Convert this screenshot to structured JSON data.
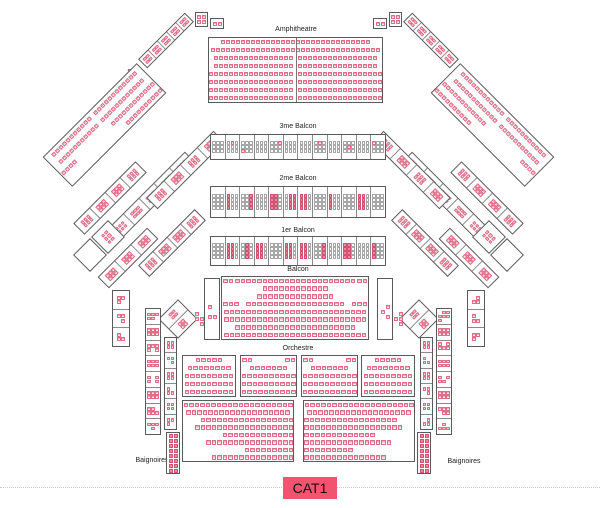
{
  "labels": {
    "amphitheatre": "Amphitheatre",
    "stalle_left": "Stalle",
    "stalle_right": "Stalle",
    "balcon_3me": "3me Balcon",
    "balcon_2me": "2me Balcon",
    "balcon_1er": "1er Balcon",
    "balcon": "Balcon",
    "orchestre": "Orchestre",
    "baignoires_left": "Baignoires",
    "baignoires_right": "Baignoires"
  },
  "legend": {
    "cat1_label": "CAT1",
    "badge_color": "#f2536f"
  },
  "seat_colors": {
    "pink_border": "#dd6b85",
    "pink_fill": "#fdeef1",
    "pink_top": "#f3aebd",
    "solid_fill": "#f287a0",
    "solid_border": "#d14f6e",
    "white_border": "#a5a5a5",
    "white_fill": "#ffffff"
  },
  "blocks": [
    {
      "name": "loge-top-left-a",
      "x": 195,
      "y": 12,
      "w": 13,
      "h": 15,
      "border": true,
      "grid": {
        "cols": 2,
        "pat": "pppp"
      },
      "seat": {
        "s": 4
      }
    },
    {
      "name": "loge-top-left-b",
      "x": 210,
      "y": 18,
      "w": 14,
      "h": 11,
      "border": true,
      "grid": {
        "cols": 2,
        "pat": "pp"
      },
      "seat": {
        "s": 4
      }
    },
    {
      "name": "loge-top-right-a",
      "x": 389,
      "y": 12,
      "w": 13,
      "h": 15,
      "border": true,
      "grid": {
        "cols": 2,
        "pat": "pppp"
      },
      "seat": {
        "s": 4
      }
    },
    {
      "name": "loge-top-right-b",
      "x": 373,
      "y": 18,
      "w": 14,
      "h": 11,
      "border": true,
      "grid": {
        "cols": 2,
        "pat": "pp"
      },
      "seat": {
        "s": 4
      }
    },
    {
      "name": "stalle-chain-left",
      "x": 133,
      "y": 34,
      "w": 66,
      "h": 13,
      "rot": -45,
      "border": true,
      "seat": {
        "s": 3.5
      },
      "cells": {
        "dir": "h",
        "cols": 2,
        "list": [
          "pppp",
          "pppp",
          "pppp",
          "pppp",
          "pppp"
        ]
      }
    },
    {
      "name": "stalle-chain-right",
      "x": 398,
      "y": 34,
      "w": 66,
      "h": 13,
      "rot": 45,
      "border": true,
      "seat": {
        "s": 3.5
      },
      "cells": {
        "dir": "h",
        "cols": 2,
        "list": [
          "pppp",
          "pppp",
          "pppp",
          "pppp",
          "pppp"
        ]
      }
    },
    {
      "name": "stalle-left-seats",
      "x": 38,
      "y": 104,
      "w": 133,
      "h": 42,
      "rot": -45,
      "border": true,
      "seat": {
        "s": 4
      },
      "rows": [
        {
          "halves": [
            11,
            12
          ]
        },
        {
          "halves": [
            11,
            12
          ]
        },
        {
          "groups": [
            4,
            12
          ]
        },
        {
          "n": 10,
          "align": "right"
        }
      ]
    },
    {
      "name": "stalle-right-seats",
      "x": 426,
      "y": 104,
      "w": 133,
      "h": 42,
      "rot": 45,
      "border": true,
      "seat": {
        "s": 4
      },
      "rows": [
        {
          "halves": [
            12,
            11
          ]
        },
        {
          "halves": [
            12,
            11
          ]
        },
        {
          "groups": [
            12,
            4
          ]
        },
        {
          "n": 10,
          "align": "left"
        }
      ]
    },
    {
      "name": "loges-diag-left-1",
      "x": 66,
      "y": 190,
      "w": 88,
      "h": 16,
      "rot": -45,
      "border": true,
      "seat": {
        "s": 3.5
      },
      "cells": {
        "dir": "h",
        "cols": 3,
        "list": [
          "pppppp",
          "pppppp",
          "pppppp",
          "pppppp"
        ]
      }
    },
    {
      "name": "loges-diag-left-2",
      "x": 97,
      "y": 188,
      "w": 110,
      "h": 17,
      "rot": -45,
      "border": true,
      "seat": {
        "s": 3.5
      },
      "cells": {
        "dir": "h",
        "cols": 3,
        "list": [
          "pppppp",
          "pppppp",
          "pppppp",
          "pppppp",
          "pppppp"
        ]
      }
    },
    {
      "name": "loges-diag-left-3",
      "x": 138,
      "y": 162,
      "w": 95,
      "h": 16,
      "rot": -45,
      "border": true,
      "seat": {
        "s": 3.5
      },
      "cells": {
        "dir": "h",
        "cols": 3,
        "list": [
          "pppppp",
          "pppppp",
          "pppppp",
          "pppppp"
        ]
      }
    },
    {
      "name": "loges-diag-left-4",
      "x": 132,
      "y": 235,
      "w": 80,
      "h": 16,
      "rot": -45,
      "border": true,
      "seat": {
        "s": 3.5
      },
      "cells": {
        "dir": "h",
        "cols": 3,
        "list": [
          "pppppp",
          "pppppp",
          "pppppp",
          "pppppp"
        ]
      }
    },
    {
      "name": "loges-diag-left-5",
      "x": 93,
      "y": 250,
      "w": 70,
      "h": 16,
      "rot": -45,
      "border": true,
      "seat": {
        "s": 3.5
      },
      "cells": {
        "dir": "h",
        "cols": 3,
        "list": [
          "pppppp",
          "pppppp",
          "pppppp"
        ]
      }
    },
    {
      "name": "loges-diag-right-1",
      "x": 443,
      "y": 190,
      "w": 88,
      "h": 16,
      "rot": 45,
      "border": true,
      "seat": {
        "s": 3.5
      },
      "cells": {
        "dir": "h",
        "cols": 3,
        "list": [
          "pppppp",
          "pppppp",
          "pppppp",
          "pppppp"
        ]
      }
    },
    {
      "name": "loges-diag-right-2",
      "x": 390,
      "y": 188,
      "w": 110,
      "h": 17,
      "rot": 45,
      "border": true,
      "seat": {
        "s": 3.5
      },
      "cells": {
        "dir": "h",
        "cols": 3,
        "list": [
          "pppppp",
          "pppppp",
          "pppppp",
          "pppppp",
          "pppppp"
        ]
      }
    },
    {
      "name": "loges-diag-right-3",
      "x": 364,
      "y": 162,
      "w": 95,
      "h": 16,
      "rot": 45,
      "border": true,
      "seat": {
        "s": 3.5
      },
      "cells": {
        "dir": "h",
        "cols": 3,
        "list": [
          "pppppp",
          "pppppp",
          "pppppp",
          "pppppp"
        ]
      }
    },
    {
      "name": "loges-diag-right-4",
      "x": 385,
      "y": 235,
      "w": 80,
      "h": 16,
      "rot": 45,
      "border": true,
      "seat": {
        "s": 3.5
      },
      "cells": {
        "dir": "h",
        "cols": 3,
        "list": [
          "pppppp",
          "pppppp",
          "pppppp",
          "pppppp"
        ]
      }
    },
    {
      "name": "loges-diag-right-5",
      "x": 434,
      "y": 250,
      "w": 70,
      "h": 16,
      "rot": 45,
      "border": true,
      "seat": {
        "s": 3.5
      },
      "cells": {
        "dir": "h",
        "cols": 3,
        "list": [
          "pppppp",
          "pppppp",
          "pppppp"
        ]
      }
    },
    {
      "name": "loge-diamond-left-seated",
      "x": 96,
      "y": 225,
      "w": 24,
      "h": 24,
      "rot": 45,
      "border": true,
      "grid": {
        "cols": 3,
        "pat": "pppppp"
      },
      "seat": {
        "s": 3.5
      }
    },
    {
      "name": "loge-diamond-left-empty",
      "x": 78,
      "y": 243,
      "w": 24,
      "h": 24,
      "rot": 45,
      "border": true,
      "grid": {
        "cols": 1,
        "pat": "e"
      },
      "seat": {
        "s": 3.5
      }
    },
    {
      "name": "loge-diamond-right-seated",
      "x": 477,
      "y": 225,
      "w": 24,
      "h": 24,
      "rot": 45,
      "border": true,
      "grid": {
        "cols": 3,
        "pat": "pppppp"
      },
      "seat": {
        "s": 3.5
      }
    },
    {
      "name": "loge-diamond-right-empty",
      "x": 495,
      "y": 243,
      "w": 24,
      "h": 24,
      "rot": 45,
      "border": true,
      "grid": {
        "cols": 1,
        "pat": "e"
      },
      "seat": {
        "s": 3.5
      }
    },
    {
      "name": "loge-pinwheel-left",
      "x": 164,
      "y": 305,
      "w": 28,
      "h": 28,
      "rot": 45,
      "border": true,
      "seat": {
        "s": 3.5
      },
      "cells": {
        "dir": "h",
        "cols": 2,
        "list": [
          "pppp",
          "pppp"
        ]
      }
    },
    {
      "name": "loge-pinwheel-right",
      "x": 405,
      "y": 305,
      "w": 28,
      "h": 28,
      "rot": 45,
      "border": true,
      "seat": {
        "s": 3.5
      },
      "cells": {
        "dir": "h",
        "cols": 2,
        "list": [
          "pppp",
          "pppp"
        ]
      }
    },
    {
      "name": "amphitheatre-seats",
      "x": 208,
      "y": 37,
      "w": 175,
      "h": 66,
      "border": true,
      "vline": true,
      "seat": {
        "s": 4
      },
      "rows": [
        {
          "n": 30
        },
        {
          "n": 34
        },
        {
          "halves": [
            16,
            16
          ]
        },
        {
          "halves": [
            16,
            16
          ]
        },
        {
          "halves": [
            17,
            17
          ]
        },
        {
          "halves": [
            17,
            17
          ]
        },
        {
          "halves": [
            17,
            17
          ]
        },
        {
          "halves": [
            17,
            17
          ]
        }
      ]
    },
    {
      "name": "balcon-3me-loges",
      "x": 210,
      "y": 134,
      "w": 176,
      "h": 26,
      "border": true,
      "seat": {
        "s": 3.5
      },
      "cells": {
        "dir": "h",
        "cols": 3,
        "list": [
          "wwwwwwwww",
          "wpwwwwwww",
          "wwwwwwpww",
          "wwwwwwwww",
          "wwpwwwwww",
          "wwwwwwwww",
          "wwwwwwwww",
          "wpwwwwwww",
          "wwwwwwwww",
          "wwwwpwwww",
          "wwwwwwwww",
          "pwwwwwwww"
        ]
      }
    },
    {
      "name": "balcon-2me-loges",
      "x": 210,
      "y": 186,
      "w": 176,
      "h": 32,
      "border": true,
      "seat": {
        "s": 3.5
      },
      "cells": {
        "dir": "h",
        "cols": 3,
        "list": [
          "wwwwwwwwwwww",
          "swwswwswwsww",
          "wwswwswwswws",
          "wwwwwwwwwwww",
          "sswsswsswssw",
          "wsswsswsswss",
          "sswsswsswssw",
          "wwwwwwwwwwww",
          "swwswwswwsww",
          "wwwwwwwwwwww",
          "sswsswsswssw",
          "wwwwwwwwwwww"
        ]
      }
    },
    {
      "name": "balcon-1er-loges",
      "x": 210,
      "y": 236,
      "w": 176,
      "h": 30,
      "border": true,
      "seat": {
        "s": 3.5
      },
      "cells": {
        "dir": "h",
        "cols": 3,
        "list": [
          "wwwwwwwwwwww",
          "sswsswsswssw",
          "wswwswwswwsw",
          "sswsswsswssw",
          "wwwwwwwwwwww",
          "sswsswsswssw",
          "sswsswsswssw",
          "wwswwswwswws",
          "wwwwwwwwwwww",
          "sswsswsswssw",
          "wwwwwwwwwwww",
          "swwswwswwsww"
        ]
      }
    },
    {
      "name": "balcon-left-box",
      "x": 204,
      "y": 278,
      "w": 16,
      "h": 62,
      "border": true,
      "grid": {
        "cols": 2,
        "pat": "eeeepeeeppee"
      },
      "seat": {
        "s": 4
      }
    },
    {
      "name": "balcon-seats",
      "x": 221,
      "y": 276,
      "w": 148,
      "h": 64,
      "border": true,
      "seat": {
        "s": 4.5
      },
      "rows": [
        {
          "groups": [
            2,
            22,
            2
          ]
        },
        {
          "n": 12
        },
        {
          "n": 14
        },
        {
          "groups": [
            3,
            18,
            3
          ]
        },
        {
          "n": 26
        },
        {
          "n": 26
        },
        {
          "n": 22
        },
        {
          "n": 26
        }
      ]
    },
    {
      "name": "balcon-right-box",
      "x": 377,
      "y": 278,
      "w": 16,
      "h": 62,
      "border": true,
      "grid": {
        "cols": 2,
        "pat": "eeeeeppeepee"
      },
      "seat": {
        "s": 4
      }
    },
    {
      "name": "balcon-outer-left",
      "x": 194,
      "y": 302,
      "w": 10,
      "h": 34,
      "grid": {
        "cols": 2,
        "pat": "peppep"
      },
      "seat": {
        "s": 4
      }
    },
    {
      "name": "balcon-outer-right",
      "x": 393,
      "y": 302,
      "w": 10,
      "h": 34,
      "grid": {
        "cols": 2,
        "pat": "epppep"
      },
      "seat": {
        "s": 4
      }
    },
    {
      "name": "orchestre-block-1",
      "x": 182,
      "y": 355,
      "w": 54,
      "h": 42,
      "border": true,
      "seat": {
        "s": 4.5
      },
      "rows": [
        {
          "n": 5
        },
        {
          "n": 8
        },
        {
          "n": 9
        },
        {
          "n": 9
        },
        {
          "n": 9
        }
      ]
    },
    {
      "name": "orchestre-block-2",
      "x": 240,
      "y": 355,
      "w": 57,
      "h": 42,
      "border": true,
      "seat": {
        "s": 4.5
      },
      "rows": [
        {
          "groups": [
            2,
            2
          ]
        },
        {
          "n": 7
        },
        {
          "n": 10
        },
        {
          "n": 10
        },
        {
          "n": 10
        }
      ]
    },
    {
      "name": "orchestre-block-3",
      "x": 301,
      "y": 355,
      "w": 57,
      "h": 42,
      "border": true,
      "seat": {
        "s": 4.5
      },
      "rows": [
        {
          "groups": [
            2,
            2
          ]
        },
        {
          "n": 7
        },
        {
          "n": 10
        },
        {
          "n": 10
        },
        {
          "n": 10
        }
      ]
    },
    {
      "name": "orchestre-block-4",
      "x": 361,
      "y": 355,
      "w": 54,
      "h": 42,
      "border": true,
      "seat": {
        "s": 4.5
      },
      "rows": [
        {
          "n": 5
        },
        {
          "n": 8
        },
        {
          "n": 9
        },
        {
          "n": 9
        },
        {
          "n": 9
        }
      ]
    },
    {
      "name": "orchestre-left-seats",
      "x": 182,
      "y": 400,
      "w": 112,
      "h": 62,
      "border": true,
      "seat": {
        "s": 4.5
      },
      "rows": [
        {
          "n": 20
        },
        {
          "n": 19
        },
        {
          "n": 17,
          "align": "right"
        },
        {
          "n": 18,
          "align": "right"
        },
        {
          "n": 13,
          "align": "right"
        },
        {
          "n": 16,
          "align": "right"
        },
        {
          "n": 9,
          "align": "right"
        },
        {
          "n": 15,
          "align": "right"
        }
      ]
    },
    {
      "name": "orchestre-right-seats",
      "x": 303,
      "y": 400,
      "w": 112,
      "h": 62,
      "border": true,
      "seat": {
        "s": 4.5
      },
      "rows": [
        {
          "n": 20
        },
        {
          "n": 19
        },
        {
          "n": 17,
          "align": "left"
        },
        {
          "n": 18,
          "align": "left"
        },
        {
          "n": 13,
          "align": "left"
        },
        {
          "n": 16,
          "align": "left"
        },
        {
          "n": 9,
          "align": "left"
        },
        {
          "n": 15,
          "align": "left"
        }
      ]
    },
    {
      "name": "loges-side-left-upper",
      "x": 112,
      "y": 290,
      "w": 18,
      "h": 57,
      "border": true,
      "seat": {
        "s": 4
      },
      "cells": {
        "dir": "v",
        "cols": 2,
        "list": [
          "pppe",
          "ppep",
          "pepp"
        ]
      }
    },
    {
      "name": "loges-side-left-mid",
      "x": 145,
      "y": 308,
      "w": 16,
      "h": 127,
      "border": true,
      "seat": {
        "s": 3.5
      },
      "cells": {
        "dir": "v",
        "cols": 3,
        "list": [
          "pppppe",
          "pppppp",
          "ppppep",
          "pppppp",
          "peppep",
          "pppppp",
          "ppeppp",
          "pppepe"
        ]
      }
    },
    {
      "name": "loges-side-left-inner",
      "x": 164,
      "y": 337,
      "w": 13,
      "h": 93,
      "border": true,
      "seat": {
        "s": 3.5
      },
      "cells": {
        "dir": "v",
        "cols": 2,
        "list": [
          "pppp",
          "ppep",
          "pppp",
          "pepp",
          "pppp",
          "pppe"
        ]
      }
    },
    {
      "name": "baignoires-left-seats",
      "x": 166,
      "y": 432,
      "w": 14,
      "h": 42,
      "border": true,
      "seat": {
        "s": 4
      },
      "grid": {
        "cols": 2,
        "pat": "ssssssssssssssss"
      }
    },
    {
      "name": "loges-side-right-upper",
      "x": 467,
      "y": 290,
      "w": 18,
      "h": 57,
      "border": true,
      "seat": {
        "s": 4
      },
      "cells": {
        "dir": "v",
        "cols": 2,
        "list": [
          "eppp",
          "pepp",
          "pppe"
        ]
      }
    },
    {
      "name": "loges-side-right-mid",
      "x": 436,
      "y": 308,
      "w": 16,
      "h": 127,
      "border": true,
      "seat": {
        "s": 3.5
      },
      "cells": {
        "dir": "v",
        "cols": 3,
        "list": [
          "epppppp",
          "pppppp",
          "peppppe",
          "pppppp",
          "pepppe",
          "pppppp",
          "pppepp",
          "epeppp"
        ]
      }
    },
    {
      "name": "loges-side-right-inner",
      "x": 420,
      "y": 337,
      "w": 13,
      "h": 93,
      "border": true,
      "seat": {
        "s": 3.5
      },
      "cells": {
        "dir": "v",
        "cols": 2,
        "list": [
          "pppp",
          "pepp",
          "pppp",
          "ppep",
          "pppp",
          "eppp"
        ]
      }
    },
    {
      "name": "baignoires-right-seats",
      "x": 417,
      "y": 432,
      "w": 14,
      "h": 42,
      "border": true,
      "seat": {
        "s": 4
      },
      "grid": {
        "cols": 2,
        "pat": "ssssssssssssssss"
      }
    }
  ]
}
